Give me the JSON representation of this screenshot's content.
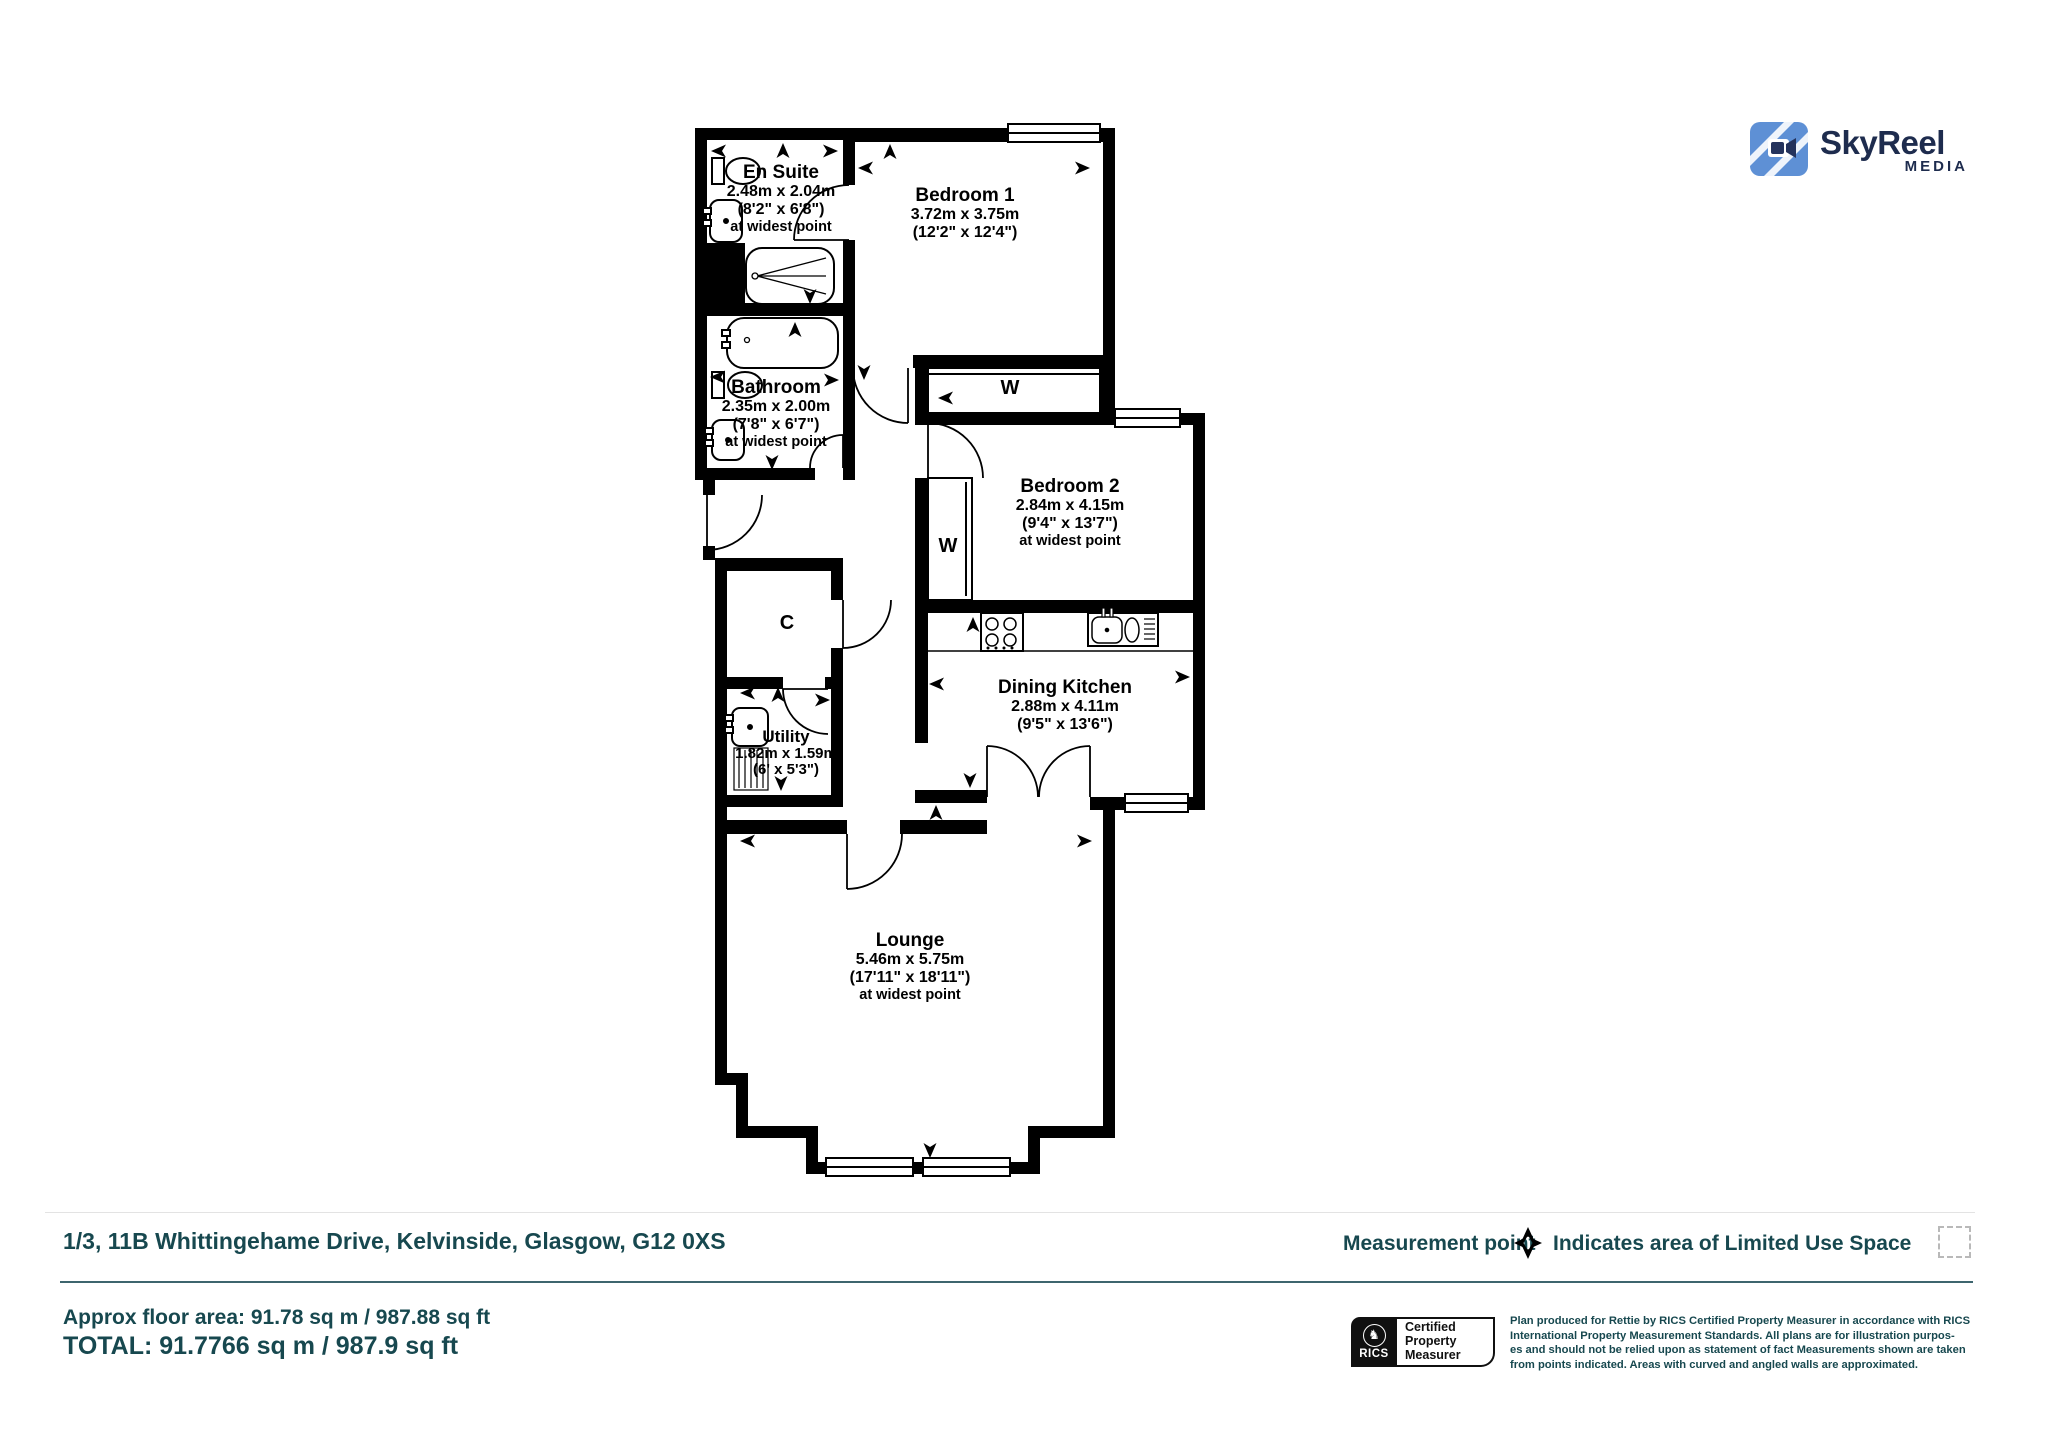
{
  "header": {
    "logo": {
      "name": "SkyReel",
      "tagline": "MEDIA",
      "icon": "skyreel-camera-icon",
      "brand_navy": "#1e2c4e",
      "brand_blue": "#5E90D5"
    }
  },
  "plan": {
    "rooms": [
      {
        "name": "En Suite",
        "size_metric": "2.48m x 2.04m",
        "size_imperial": "(8'2\" x 6'8\")",
        "note": "at widest point"
      },
      {
        "name": "Bedroom 1",
        "size_metric": "3.72m x 3.75m",
        "size_imperial": "(12'2\" x 12'4\")"
      },
      {
        "name": "W"
      },
      {
        "name": "Bathroom",
        "size_metric": "2.35m x 2.00m",
        "size_imperial": "(7'8\" x 6'7\")",
        "note": "at widest point"
      },
      {
        "name": "Bedroom 2",
        "size_metric": "2.84m x 4.15m",
        "size_imperial": "(9'4\" x 13'7\")",
        "note": "at widest point"
      },
      {
        "name": "W"
      },
      {
        "name": "C"
      },
      {
        "name": "Utility",
        "size_metric": "1.82m x 1.59m",
        "size_imperial": "(6' x 5'3\")"
      },
      {
        "name": "Dining Kitchen",
        "size_metric": "2.88m x 4.11m",
        "size_imperial": "(9'5\" x 13'6\")"
      },
      {
        "name": "Lounge",
        "size_metric": "5.46m x 5.75m",
        "size_imperial": "(17'11\" x 18'11\")",
        "note": "at widest point"
      }
    ]
  },
  "footer": {
    "address": "1/3, 11B Whittingehame Drive, Kelvinside, Glasgow, G12 0XS",
    "approx_area": "Approx floor area: 91.78 sq m / 987.88 sq ft",
    "total": "TOTAL: 91.7766 sq m / 987.9 sq ft",
    "legend": {
      "measurement_point_label": "Measurement point",
      "measurement_point_icon": "four-way-arrow-icon",
      "limited_use_label": "Indicates area of Limited Use Space",
      "limited_use_icon": "dashed-box-icon"
    },
    "rics": {
      "brand": "RICS",
      "lion_icon": "rics-lion-icon",
      "cert_line1": "Certified",
      "cert_line2": "Property",
      "cert_line3": "Measurer"
    },
    "disclaimer_line1": "Plan produced for Rettie by RICS Certified Property Measurer in accordance with RICS",
    "disclaimer_line2": "International Property Measurement Standards. All plans are for illustration purpos-",
    "disclaimer_line3": "es and should not be relied upon as statement of fact Measurements shown are taken",
    "disclaimer_line4": "from points indicated. Areas with curved and angled walls are approximated.",
    "text_color": "#17484f",
    "rule_color": "#3d656e"
  },
  "icons": {
    "rics_lion_glyph": "♞"
  }
}
